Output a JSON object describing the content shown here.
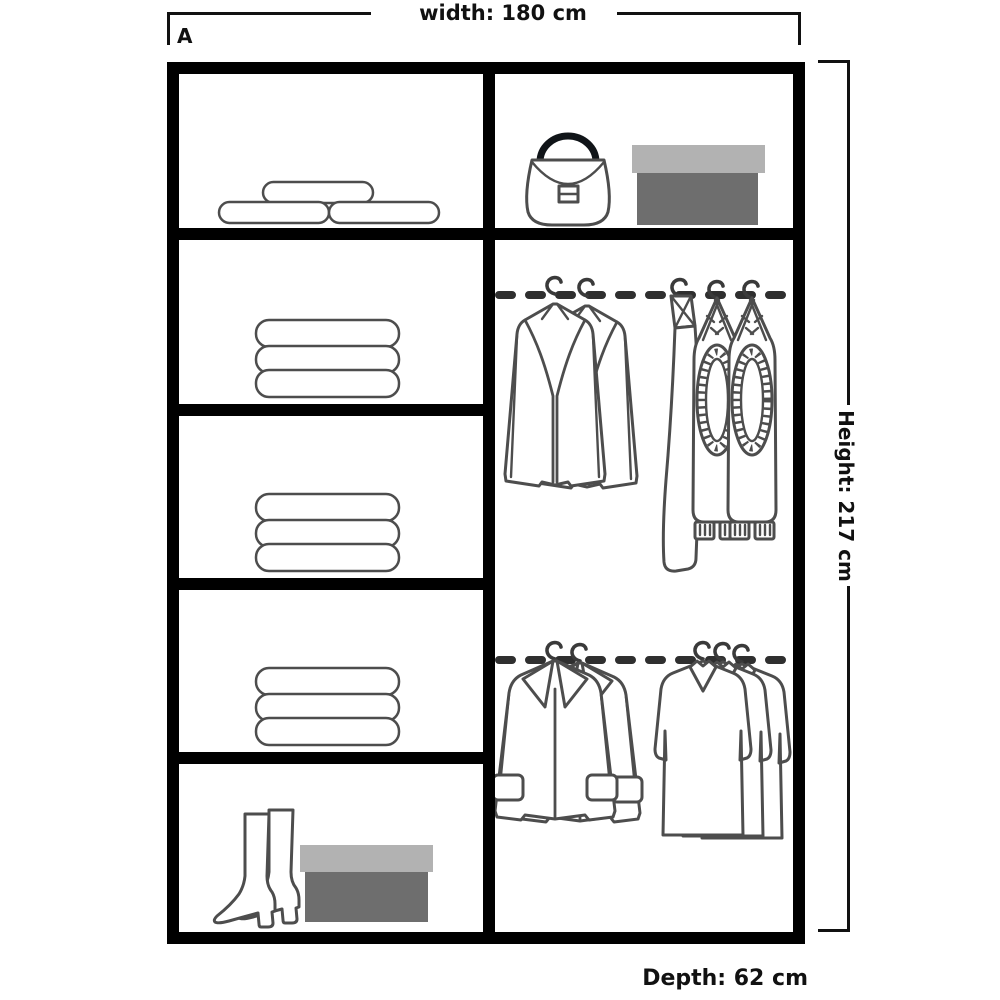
{
  "diagram": {
    "variant_label": "A",
    "dimensions": {
      "width_label": "width: 180 cm",
      "height_label": "Height: 217 cm",
      "depth_label": "Depth: 62 cm"
    },
    "colors": {
      "frame": "#000000",
      "outline": "#4d4d4d",
      "rail": "#2f2f2f",
      "box_lid": "#b2b2b2",
      "box_body": "#6e6e6e"
    },
    "left_column": {
      "compartments": [
        {
          "name": "top-shelf",
          "contents": [
            "pillow-rolls-icon"
          ]
        },
        {
          "name": "shelf-2",
          "contents": [
            "folded-linen-stack-icon"
          ]
        },
        {
          "name": "shelf-3",
          "contents": [
            "folded-linen-stack-icon"
          ]
        },
        {
          "name": "shelf-4",
          "contents": [
            "folded-linen-stack-icon"
          ]
        },
        {
          "name": "bottom-shelf",
          "contents": [
            "boots-icon",
            "shoe-box-icon"
          ]
        }
      ]
    },
    "right_column": {
      "compartments": [
        {
          "name": "top-shelf",
          "contents": [
            "handbag-icon",
            "shoe-box-icon"
          ]
        },
        {
          "name": "hanging-area",
          "contents": [
            "clothes-rail-top",
            "jackets-on-hangers-icon",
            "trousers-on-hangers-icon",
            "clothes-rail-bottom",
            "coats-on-hangers-icon",
            "shirts-on-hangers-icon"
          ]
        }
      ]
    }
  }
}
